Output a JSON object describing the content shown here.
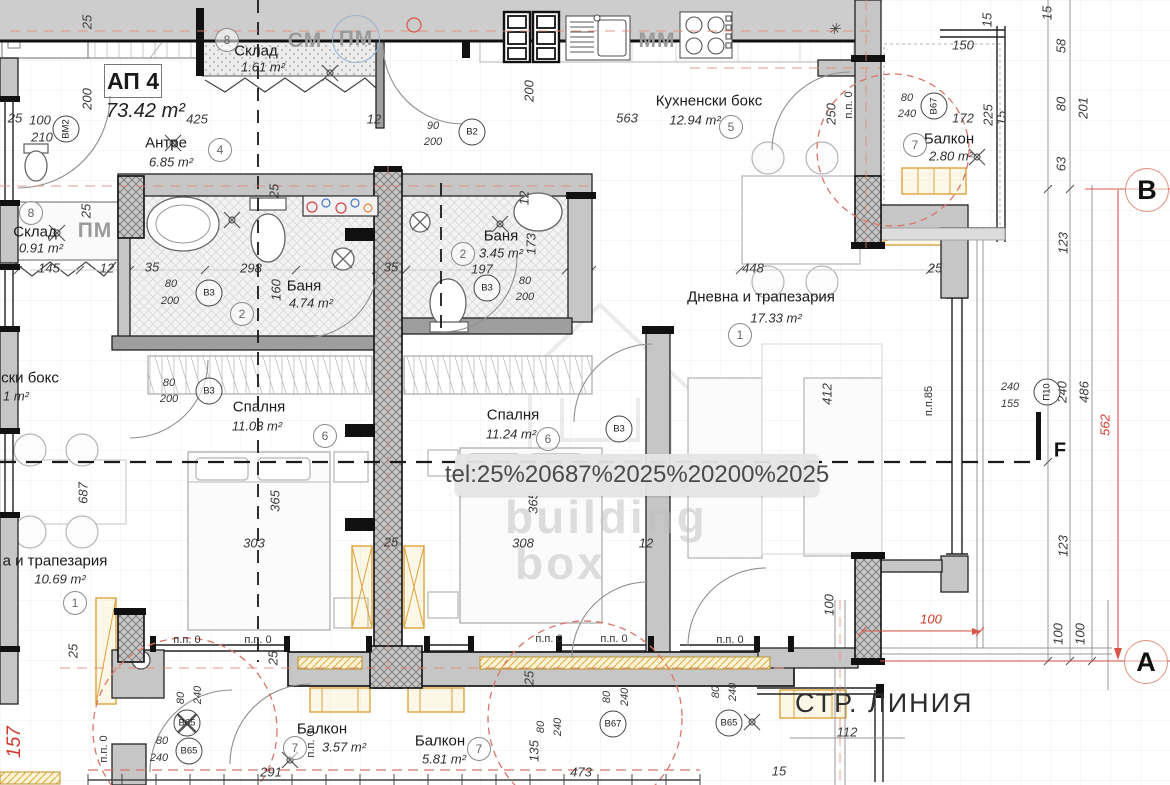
{
  "apartment": {
    "id": "АП 4",
    "area_label": "73.42 m²"
  },
  "street_line": "СТР. ЛИНИЯ",
  "watermark": {
    "tooltip": "tel:25%20687%2025%20200%2025",
    "brand_top": "building",
    "brand_bottom": "box"
  },
  "axes": [
    {
      "label": "В",
      "x": 1147,
      "y": 190
    },
    {
      "label": "А",
      "x": 1146,
      "y": 662
    }
  ],
  "section_flag": {
    "label": "F",
    "x": 1060,
    "y": 451
  },
  "rooms": [
    {
      "name": "Антре",
      "area": "6.85 m²",
      "num": "4",
      "nx": 166,
      "ny": 143,
      "ax": 171,
      "ay": 162,
      "cx": 220,
      "cy": 150
    },
    {
      "name": "Склад",
      "area": "1.61 m²",
      "num": "8",
      "nx": 256,
      "ny": 51,
      "ax": 263,
      "ay": 67,
      "cx": 227,
      "cy": 40
    },
    {
      "name": "Склад",
      "area": "0.91 m²",
      "num": "8",
      "nx": 35,
      "ny": 232,
      "ax": 41,
      "ay": 248,
      "cx": 31,
      "cy": 213
    },
    {
      "name": "Баня",
      "area": "4.74 m²",
      "num": "2",
      "nx": 304,
      "ny": 286,
      "ax": 311,
      "ay": 303,
      "cx": 242,
      "cy": 314
    },
    {
      "name": "Баня",
      "area": "3.45 m²",
      "num": "2",
      "nx": 501,
      "ny": 236,
      "ax": 501,
      "ay": 253,
      "cx": 463,
      "cy": 254
    },
    {
      "name": "Кухненски бокс",
      "area": "12.94 m²",
      "num": "5",
      "nx": 709,
      "ny": 101,
      "ax": 695,
      "ay": 120,
      "cx": 731,
      "cy": 127
    },
    {
      "name": "Балкон",
      "area": "2.80 m²",
      "num": "7",
      "nx": 949,
      "ny": 139,
      "ax": 951,
      "ay": 156,
      "cx": 915,
      "cy": 145
    },
    {
      "name": "Дневна и трапезария",
      "area": "17.33 m²",
      "num": "1",
      "nx": 761,
      "ny": 297,
      "ax": 776,
      "ay": 318,
      "cx": 740,
      "cy": 335
    },
    {
      "name": "Спалня",
      "area": "11.03 m²",
      "num": "6",
      "nx": 259,
      "ny": 407,
      "ax": 257,
      "ay": 426,
      "cx": 325,
      "cy": 436
    },
    {
      "name": "Спалня",
      "area": "11.24 m²",
      "num": "6",
      "nx": 513,
      "ny": 415,
      "ax": 511,
      "ay": 434,
      "cx": 548,
      "cy": 439
    },
    {
      "name": "а и трапезария",
      "area": "10.69 m²",
      "num": "1",
      "nx": 55,
      "ny": 561,
      "ax": 60,
      "ay": 579,
      "cx": 75,
      "cy": 603
    },
    {
      "name": "Балкон",
      "area": "3.57 m²",
      "num": "7",
      "nx": 322,
      "ny": 729,
      "ax": 344,
      "ay": 747,
      "cx": 295,
      "cy": 748
    },
    {
      "name": "Балкон",
      "area": "5.81 m²",
      "num": "7",
      "nx": 440,
      "ny": 741,
      "ax": 444,
      "ay": 759,
      "cx": 479,
      "cy": 749
    },
    {
      "name": "ски бокс",
      "area": "1 m²",
      "num": null,
      "nx": 30,
      "ny": 378,
      "ax": 16,
      "ay": 396,
      "cx": null,
      "cy": null
    }
  ],
  "appliances": [
    {
      "t": "СМ",
      "x": 305,
      "y": 41
    },
    {
      "t": "ПМ",
      "x": 356,
      "y": 39,
      "circled": true
    },
    {
      "t": "ММ",
      "x": 657,
      "y": 41
    },
    {
      "t": "ПМ",
      "x": 95,
      "y": 231
    }
  ],
  "door_tags": [
    {
      "t": "В2",
      "x": 472,
      "y": 132
    },
    {
      "t": "В3",
      "x": 209,
      "y": 293
    },
    {
      "t": "В3",
      "x": 487,
      "y": 288
    },
    {
      "t": "В3",
      "x": 209,
      "y": 391
    },
    {
      "t": "В3",
      "x": 619,
      "y": 429
    },
    {
      "t": "В67",
      "x": 934,
      "y": 106,
      "r": -90
    },
    {
      "t": "В67",
      "x": 613,
      "y": 724
    },
    {
      "t": "В65",
      "x": 187,
      "y": 723,
      "crossed": true
    },
    {
      "t": "В65",
      "x": 189,
      "y": 751
    },
    {
      "t": "В65",
      "x": 729,
      "y": 723
    },
    {
      "t": "ВМ2",
      "x": 66,
      "y": 129,
      "r": -90
    },
    {
      "t": "П10",
      "x": 1047,
      "y": 392,
      "r": -90
    }
  ],
  "pp_labels": [
    {
      "t": "п.п. 0",
      "x": 187,
      "y": 640
    },
    {
      "t": "п.п. 0",
      "x": 258,
      "y": 640
    },
    {
      "t": "п.п. 0",
      "x": 549,
      "y": 639
    },
    {
      "t": "п.п. 0",
      "x": 614,
      "y": 639
    },
    {
      "t": "п.п. 0",
      "x": 730,
      "y": 640
    },
    {
      "t": "п.п. 0",
      "x": 311,
      "y": 744,
      "r": -90
    },
    {
      "t": "п.п. 0",
      "x": 104,
      "y": 749,
      "r": -90
    },
    {
      "t": "п.п. 0",
      "x": 849,
      "y": 105,
      "r": -90
    },
    {
      "t": "п.п.85",
      "x": 929,
      "y": 401,
      "r": -90
    }
  ],
  "dimensions": [
    {
      "t": "25",
      "x": 87,
      "y": 22,
      "r": -90
    },
    {
      "t": "200",
      "x": 87,
      "y": 99,
      "r": -90
    },
    {
      "t": "25",
      "x": 15,
      "y": 118
    },
    {
      "t": "100",
      "x": 40,
      "y": 120
    },
    {
      "t": "210",
      "x": 42,
      "y": 137
    },
    {
      "t": "425",
      "x": 197,
      "y": 119
    },
    {
      "t": "12",
      "x": 374,
      "y": 119
    },
    {
      "t": "90",
      "x": 433,
      "y": 126,
      "s": 11
    },
    {
      "t": "200",
      "x": 433,
      "y": 142,
      "s": 11
    },
    {
      "t": "200",
      "x": 529,
      "y": 91,
      "r": -90
    },
    {
      "t": "563",
      "x": 627,
      "y": 118
    },
    {
      "t": "250",
      "x": 831,
      "y": 114,
      "r": -90
    },
    {
      "t": "150",
      "x": 963,
      "y": 45
    },
    {
      "t": "15",
      "x": 987,
      "y": 20,
      "r": -90
    },
    {
      "t": "80",
      "x": 907,
      "y": 98,
      "s": 11
    },
    {
      "t": "240",
      "x": 907,
      "y": 114,
      "s": 11
    },
    {
      "t": "172",
      "x": 963,
      "y": 118
    },
    {
      "t": "225",
      "x": 988,
      "y": 115,
      "r": -90
    },
    {
      "t": "15",
      "x": 1001,
      "y": 118,
      "r": -90
    },
    {
      "t": "15",
      "x": 1047,
      "y": 13,
      "r": -90
    },
    {
      "t": "58",
      "x": 1061,
      "y": 46,
      "r": -90
    },
    {
      "t": "80",
      "x": 1061,
      "y": 104,
      "r": -90
    },
    {
      "t": "201",
      "x": 1083,
      "y": 108,
      "r": -90
    },
    {
      "t": "63",
      "x": 1061,
      "y": 164,
      "r": -90
    },
    {
      "t": "✳",
      "x": 834,
      "y": 29,
      "s": 15
    },
    {
      "t": "145",
      "x": 49,
      "y": 268
    },
    {
      "t": "12",
      "x": 107,
      "y": 268
    },
    {
      "t": "35",
      "x": 152,
      "y": 267
    },
    {
      "t": "298",
      "x": 251,
      "y": 268
    },
    {
      "t": "35",
      "x": 391,
      "y": 267
    },
    {
      "t": "80",
      "x": 171,
      "y": 284,
      "s": 11
    },
    {
      "t": "200",
      "x": 170,
      "y": 301,
      "s": 11
    },
    {
      "t": "160",
      "x": 276,
      "y": 290,
      "r": -90
    },
    {
      "t": "25",
      "x": 86,
      "y": 211,
      "r": -90
    },
    {
      "t": "25",
      "x": 274,
      "y": 191,
      "r": -90
    },
    {
      "t": "12",
      "x": 524,
      "y": 198,
      "r": -90
    },
    {
      "t": "173",
      "x": 531,
      "y": 244,
      "r": -90
    },
    {
      "t": "197",
      "x": 482,
      "y": 269
    },
    {
      "t": "80",
      "x": 525,
      "y": 281,
      "s": 11
    },
    {
      "t": "200",
      "x": 525,
      "y": 297,
      "s": 11
    },
    {
      "t": "448",
      "x": 753,
      "y": 268
    },
    {
      "t": "25",
      "x": 935,
      "y": 268
    },
    {
      "t": "412",
      "x": 827,
      "y": 394,
      "r": -90
    },
    {
      "t": "687",
      "x": 83,
      "y": 493,
      "r": -90
    },
    {
      "t": "80",
      "x": 169,
      "y": 383,
      "s": 11
    },
    {
      "t": "200",
      "x": 169,
      "y": 399,
      "s": 11
    },
    {
      "t": "365",
      "x": 275,
      "y": 501,
      "r": -90
    },
    {
      "t": "303",
      "x": 254,
      "y": 543
    },
    {
      "t": "25",
      "x": 391,
      "y": 542
    },
    {
      "t": "365",
      "x": 533,
      "y": 503,
      "r": -90
    },
    {
      "t": "308",
      "x": 523,
      "y": 543
    },
    {
      "t": "12",
      "x": 646,
      "y": 543
    },
    {
      "t": "240",
      "x": 1010,
      "y": 387,
      "s": 11
    },
    {
      "t": "155",
      "x": 1010,
      "y": 404,
      "s": 11
    },
    {
      "t": "240",
      "x": 1062,
      "y": 392,
      "r": -90
    },
    {
      "t": "486",
      "x": 1084,
      "y": 392,
      "r": -90
    },
    {
      "t": "123",
      "x": 1063,
      "y": 243,
      "r": -90
    },
    {
      "t": "123",
      "x": 1063,
      "y": 546,
      "r": -90
    },
    {
      "t": "562",
      "x": 1105,
      "y": 425,
      "r": -90,
      "red": true
    },
    {
      "t": "100",
      "x": 1058,
      "y": 634,
      "r": -90
    },
    {
      "t": "100",
      "x": 1080,
      "y": 634,
      "r": -90
    },
    {
      "t": "100",
      "x": 931,
      "y": 619,
      "red": true
    },
    {
      "t": "100",
      "x": 829,
      "y": 605,
      "r": -90
    },
    {
      "t": "112",
      "x": 847,
      "y": 732
    },
    {
      "t": "15",
      "x": 779,
      "y": 771
    },
    {
      "t": "291",
      "x": 271,
      "y": 772
    },
    {
      "t": "473",
      "x": 581,
      "y": 772
    },
    {
      "t": "135",
      "x": 534,
      "y": 751,
      "r": -90
    },
    {
      "t": "80",
      "x": 541,
      "y": 727,
      "r": -90,
      "s": 11
    },
    {
      "t": "240",
      "x": 558,
      "y": 727,
      "r": -90,
      "s": 11
    },
    {
      "t": "80",
      "x": 607,
      "y": 697,
      "r": -90,
      "s": 11
    },
    {
      "t": "240",
      "x": 625,
      "y": 697,
      "r": -90,
      "s": 11
    },
    {
      "t": "80",
      "x": 716,
      "y": 692,
      "r": -90,
      "s": 11
    },
    {
      "t": "240",
      "x": 733,
      "y": 692,
      "r": -90,
      "s": 11
    },
    {
      "t": "80",
      "x": 181,
      "y": 698,
      "r": -90,
      "s": 11
    },
    {
      "t": "240",
      "x": 198,
      "y": 695,
      "r": -90,
      "s": 11
    },
    {
      "t": "80",
      "x": 162,
      "y": 741,
      "s": 11
    },
    {
      "t": "240",
      "x": 159,
      "y": 758,
      "s": 11
    },
    {
      "t": "157",
      "x": 15,
      "y": 742,
      "r": -90,
      "red": true,
      "s": 19
    },
    {
      "t": "25",
      "x": 73,
      "y": 651,
      "r": -90
    },
    {
      "t": "25",
      "x": 273,
      "y": 658,
      "r": -90
    },
    {
      "t": "25",
      "x": 529,
      "y": 678,
      "r": -90
    }
  ]
}
